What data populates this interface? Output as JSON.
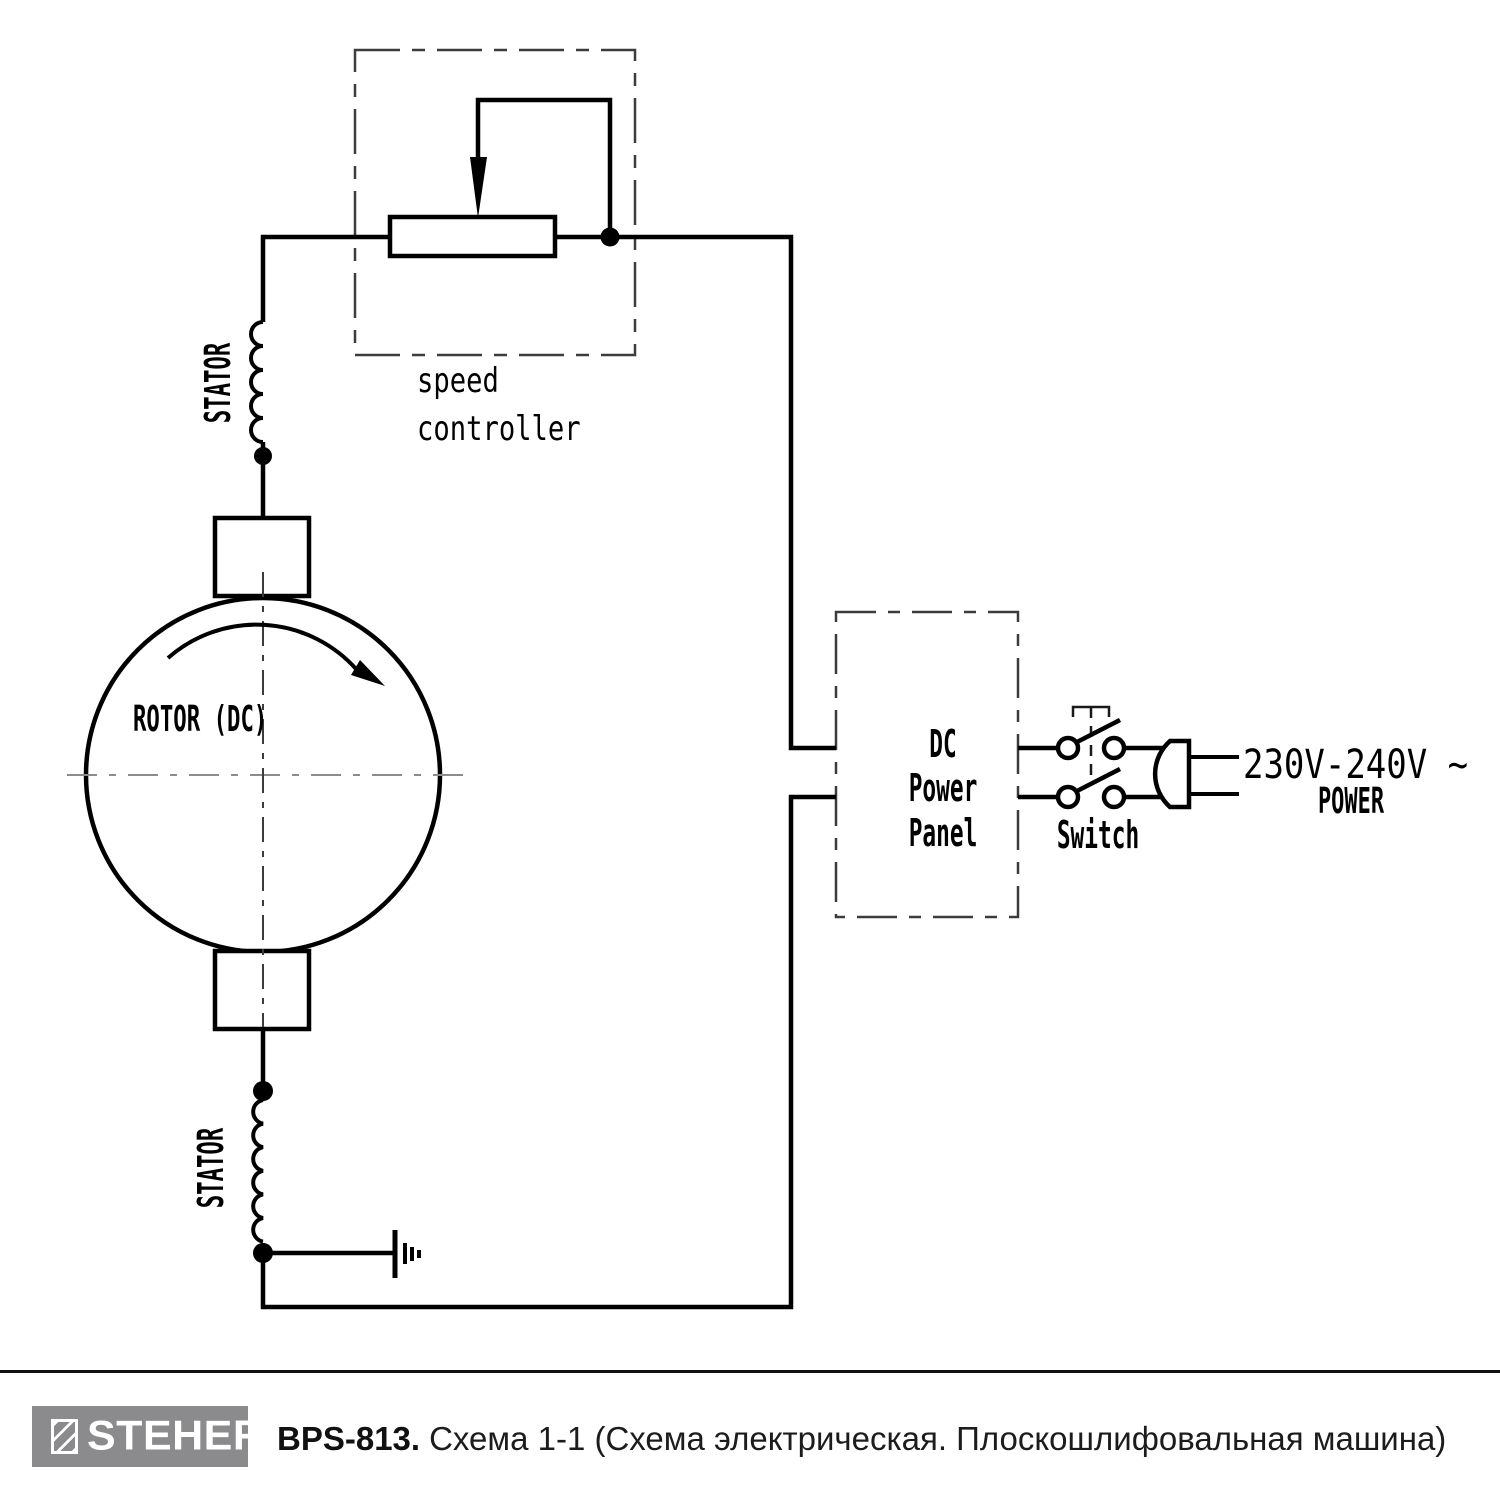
{
  "diagram": {
    "labels": {
      "speed_controller_line1": "speed",
      "speed_controller_line2": "controller",
      "stator_top": "STATOR",
      "stator_bottom": "STATOR",
      "rotor": "ROTOR (DC)",
      "dc_panel_line1": "DC",
      "dc_panel_line2": "Power",
      "dc_panel_line3": "Panel",
      "switch": "Switch",
      "voltage": "230V-240V ~",
      "power": "POWER"
    },
    "colors": {
      "line": "#000000",
      "centerline_dark": "#3c3c3c",
      "centerline_gray": "#8c8c8c"
    }
  },
  "footer": {
    "brand": "STEHER",
    "model": "BPS-813.",
    "caption": "Схема 1-1 (Схема электрическая. Плоскошлифовальная машина)",
    "logo_background": "#8b8b8e"
  }
}
